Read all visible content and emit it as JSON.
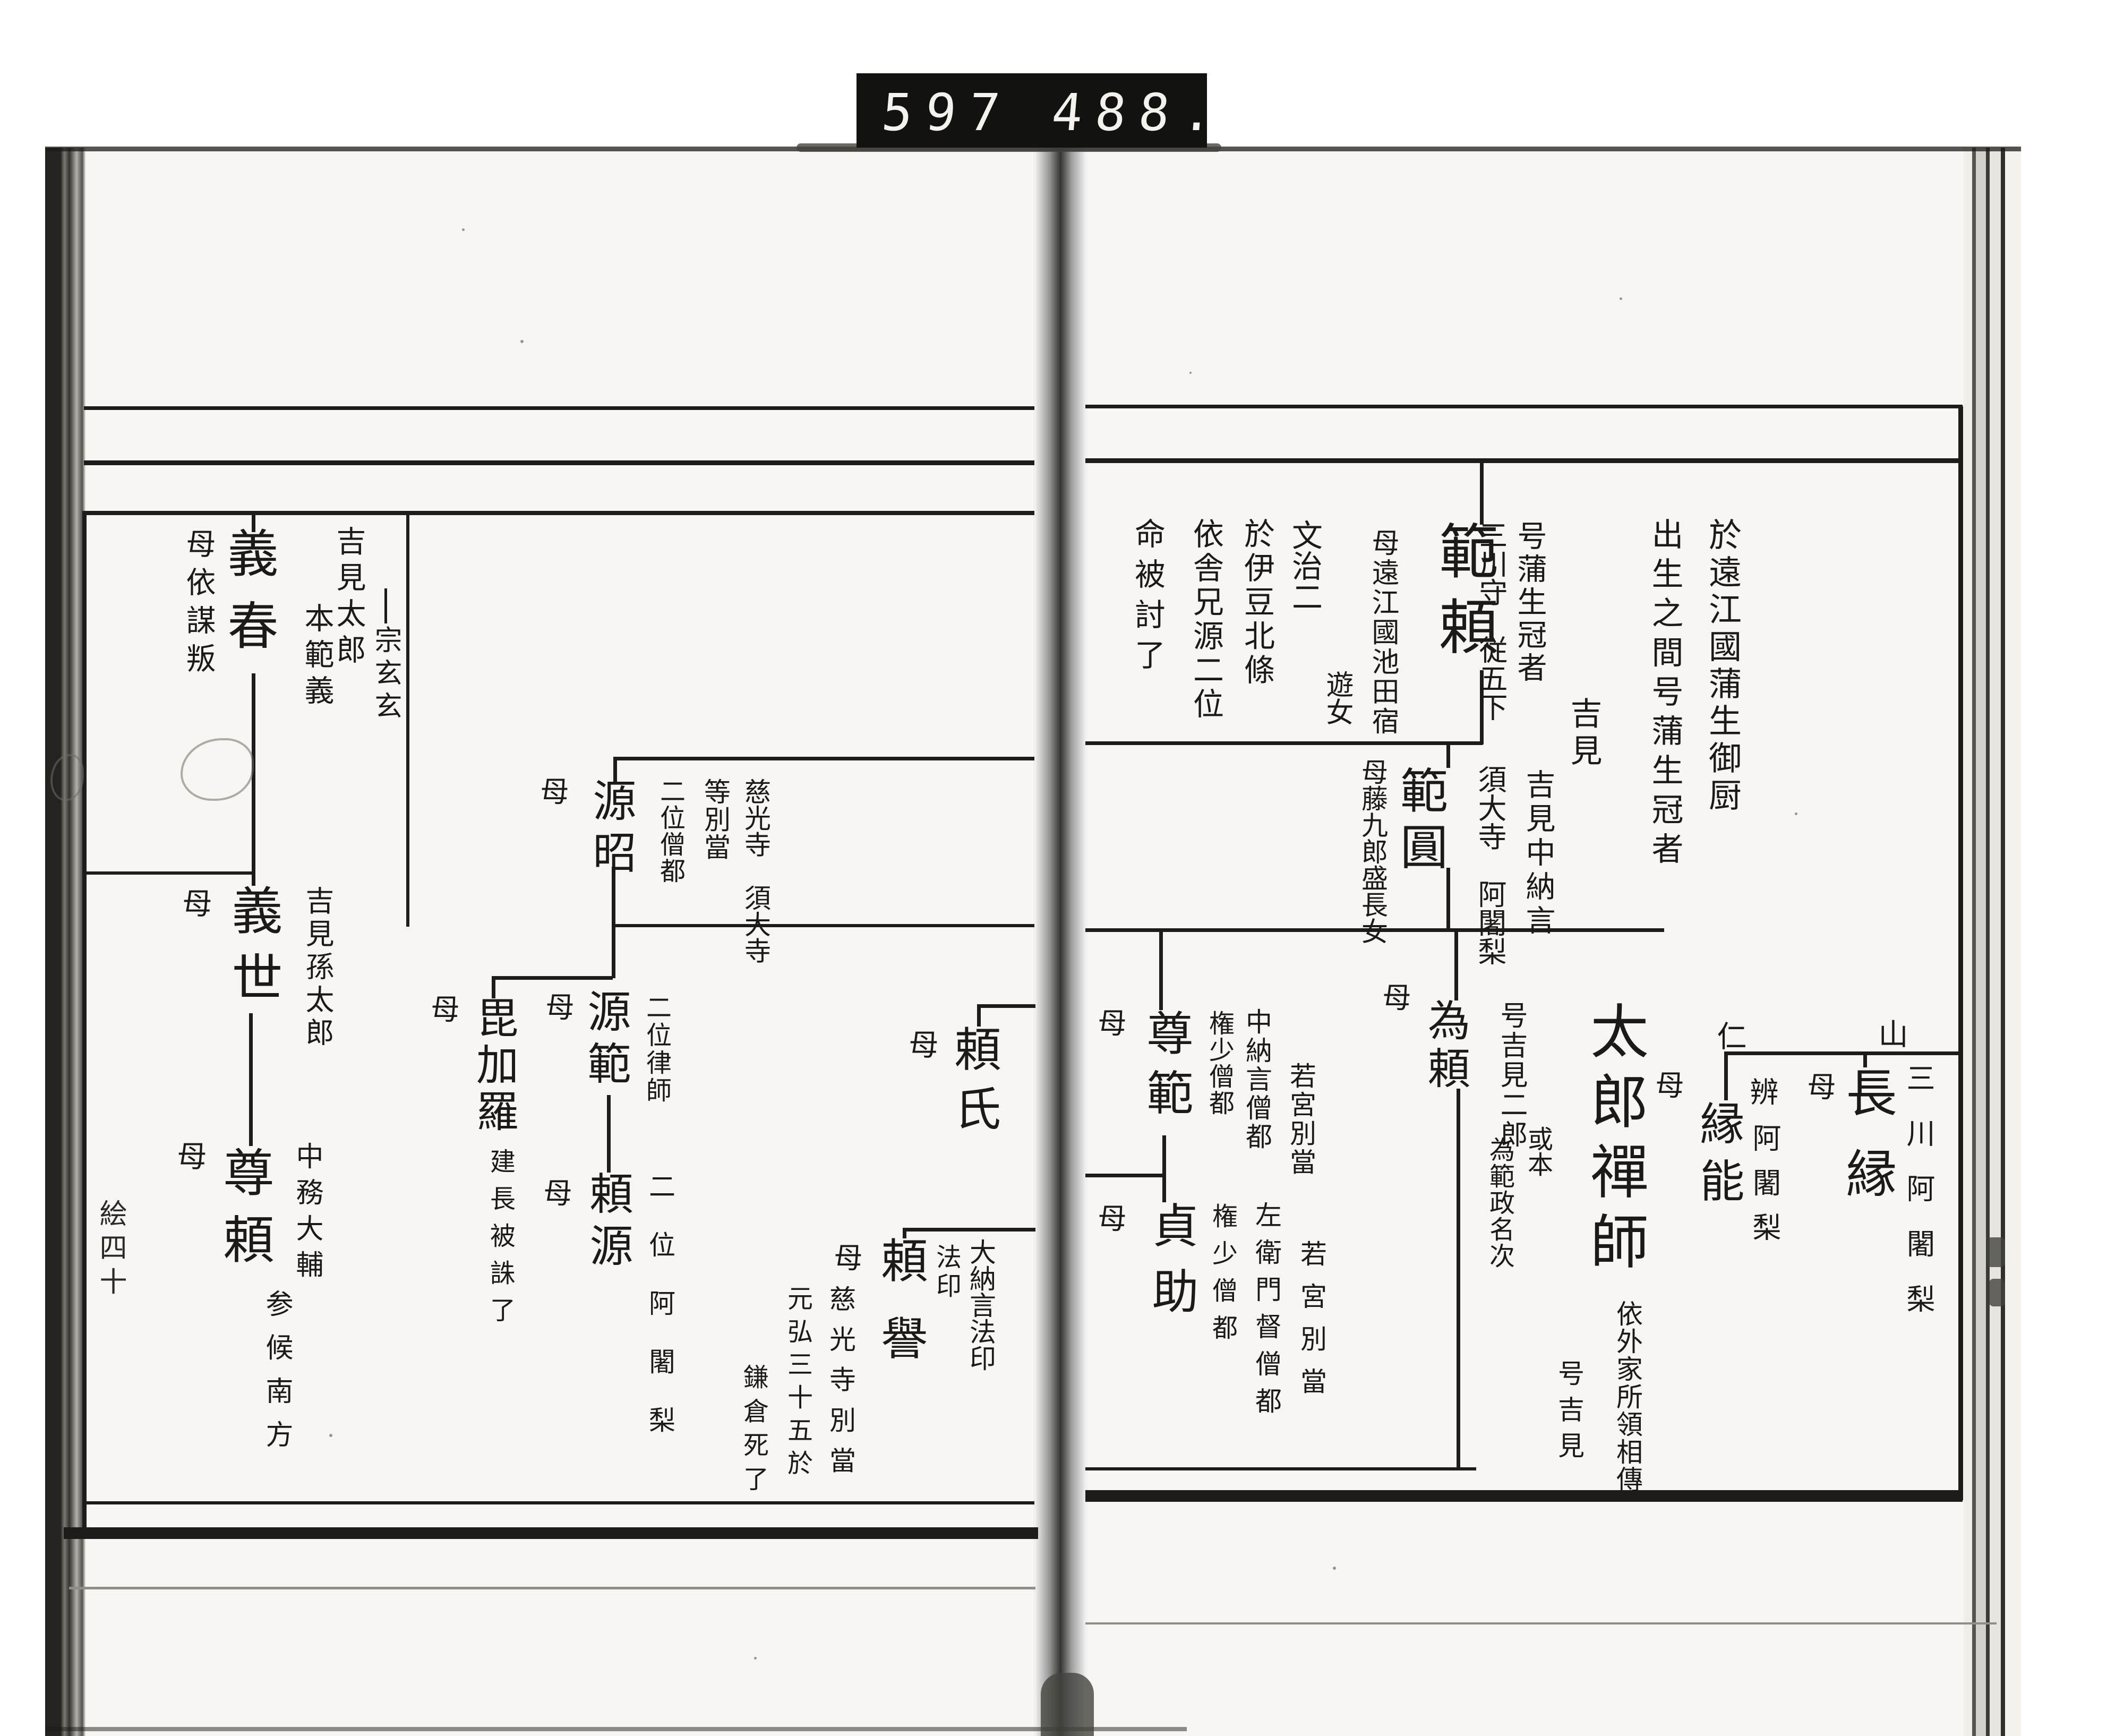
{
  "counter": {
    "left": "597",
    "right": "488."
  },
  "right_page": {
    "header_notes": {
      "origin": "於遠江國蒲生御厨",
      "birth": "出生之間号蒲生冠者"
    },
    "clan_label": "吉見",
    "noriyori": {
      "name": "範頼",
      "alias": "号蒲生冠者",
      "rank": "三川守　従五下",
      "mother": "母遠江國池田宿",
      "mother2": "遊女",
      "death": [
        "文治二",
        "於伊豆北條",
        "依舎兄源二位",
        "命被討了"
      ]
    },
    "hanen": {
      "name": "範圓",
      "title1": "吉見中納言",
      "title2": "須大寺　阿闍梨",
      "mother": "母藤九郎盛長女"
    },
    "tameyori": {
      "name": "為頼",
      "mother": "母",
      "alias": "号吉見二郎",
      "variant": "或本",
      "variant2": "為範政名次"
    },
    "taro_zenji": {
      "name": "太郎禪師",
      "note1": "依外家所領相傳",
      "note2": "号吉見"
    },
    "sonpan": {
      "name": "尊範",
      "mother": "母",
      "t1": "若宮別當",
      "t2": "中納言僧都",
      "t3": "権少僧都"
    },
    "teisuke": {
      "name": "貞助",
      "mother": "母",
      "t1": "若宮別當",
      "t2": "左衛門督僧都",
      "t3": "権少僧都"
    },
    "enno": {
      "name": "縁能",
      "mother": "母",
      "t1": "辨",
      "t2": "阿闍梨",
      "marker": "仁"
    },
    "choen": {
      "name": "長縁",
      "mother": "母",
      "t1": "三川阿闍梨",
      "marker": "山"
    }
  },
  "left_page": {
    "page_marker": "絵四十",
    "sogen_label": "宗玄玄",
    "yoshiharu": {
      "name": "義春",
      "t1": "吉見太郎",
      "t2": "本範義",
      "mother": "母依謀叛"
    },
    "yoshiyo": {
      "name": "義世",
      "mother": "母",
      "t1": "吉見孫太郎"
    },
    "sonrai": {
      "name": "尊頼",
      "mother": "母",
      "t1": "中務大輔",
      "note": "参候南方"
    },
    "gensho": {
      "name": "源昭",
      "mother": "母",
      "t1": "慈光寺　須大寺",
      "t2": "等別當",
      "t3": "二位僧都"
    },
    "genpan": {
      "name": "源範",
      "mother": "母",
      "t1": "二位律師"
    },
    "bikara": {
      "name": "毘加羅",
      "mother": "母",
      "note": "建長被誅了"
    },
    "raigen": {
      "name": "頼源",
      "mother": "母",
      "t1": "二位阿闍梨"
    },
    "yoriuji": {
      "name": "頼氏",
      "mother": "母"
    },
    "raiyo": {
      "name": "頼譽",
      "t1": "大納言法印",
      "t2": "法印",
      "mother": "母",
      "n1": "慈光寺別當",
      "n2": "元弘三十五於",
      "n3": "鎌倉死了"
    }
  }
}
